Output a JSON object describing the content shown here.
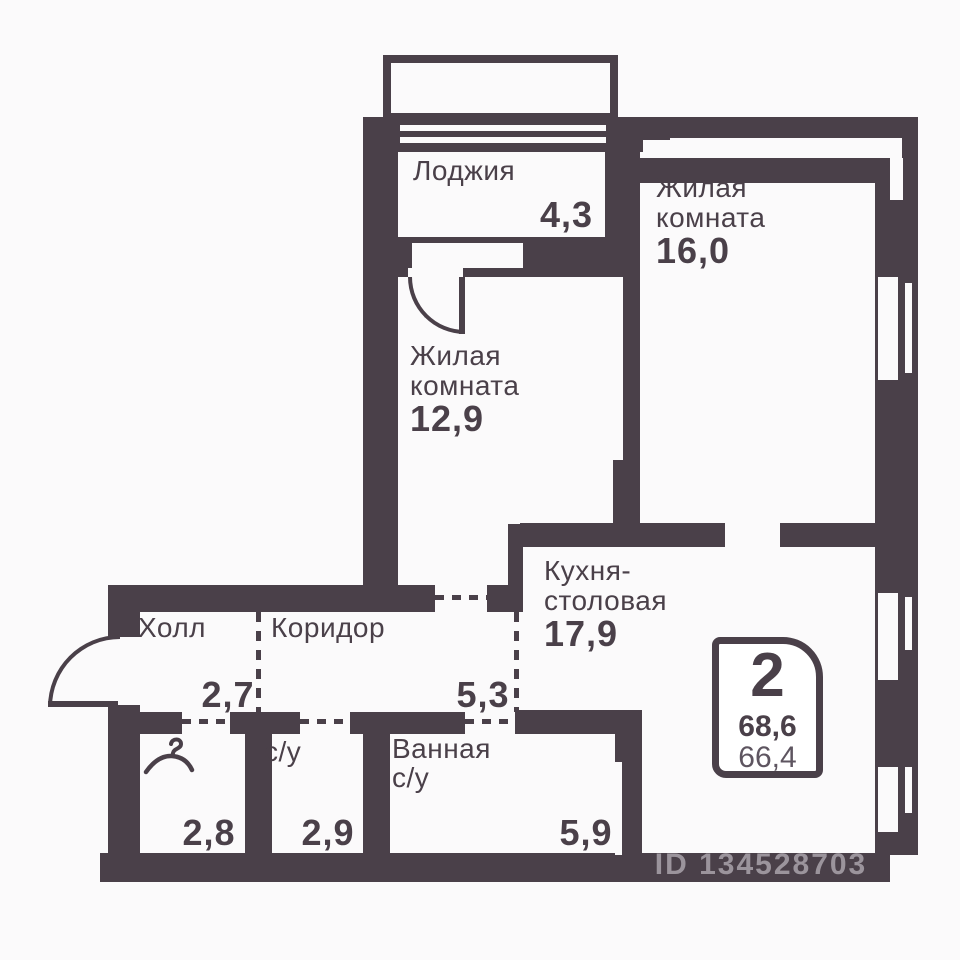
{
  "colors": {
    "wall": "#4a4049",
    "background": "#fbfafb",
    "secondary_text": "#5e5560",
    "watermark": "rgba(223,217,224,0.55)"
  },
  "rooms": {
    "loggia": {
      "label": "Лоджия",
      "area": "4,3"
    },
    "living_top": {
      "label_line1": "Жилая",
      "label_line2": "комната",
      "area": "16,0"
    },
    "living_mid": {
      "label_line1": "Жилая",
      "label_line2": "комната",
      "area": "12,9"
    },
    "kitchen": {
      "label_line1": "Кухня-",
      "label_line2": "столовая",
      "area": "17,9"
    },
    "hall": {
      "label": "Холл",
      "area": "2,7"
    },
    "corridor": {
      "label": "Коридор",
      "area": "5,3"
    },
    "wc": {
      "label": "с/у",
      "area": "2,9"
    },
    "bathroom": {
      "label_line1": "Ванная",
      "label_line2": "с/у",
      "area": "5,9"
    },
    "wardrobe": {
      "area": "2,8"
    }
  },
  "badge": {
    "rooms_count": "2",
    "total_area": "68,6",
    "living_area": "66,4"
  },
  "watermark": {
    "id": "ID 134528703"
  }
}
